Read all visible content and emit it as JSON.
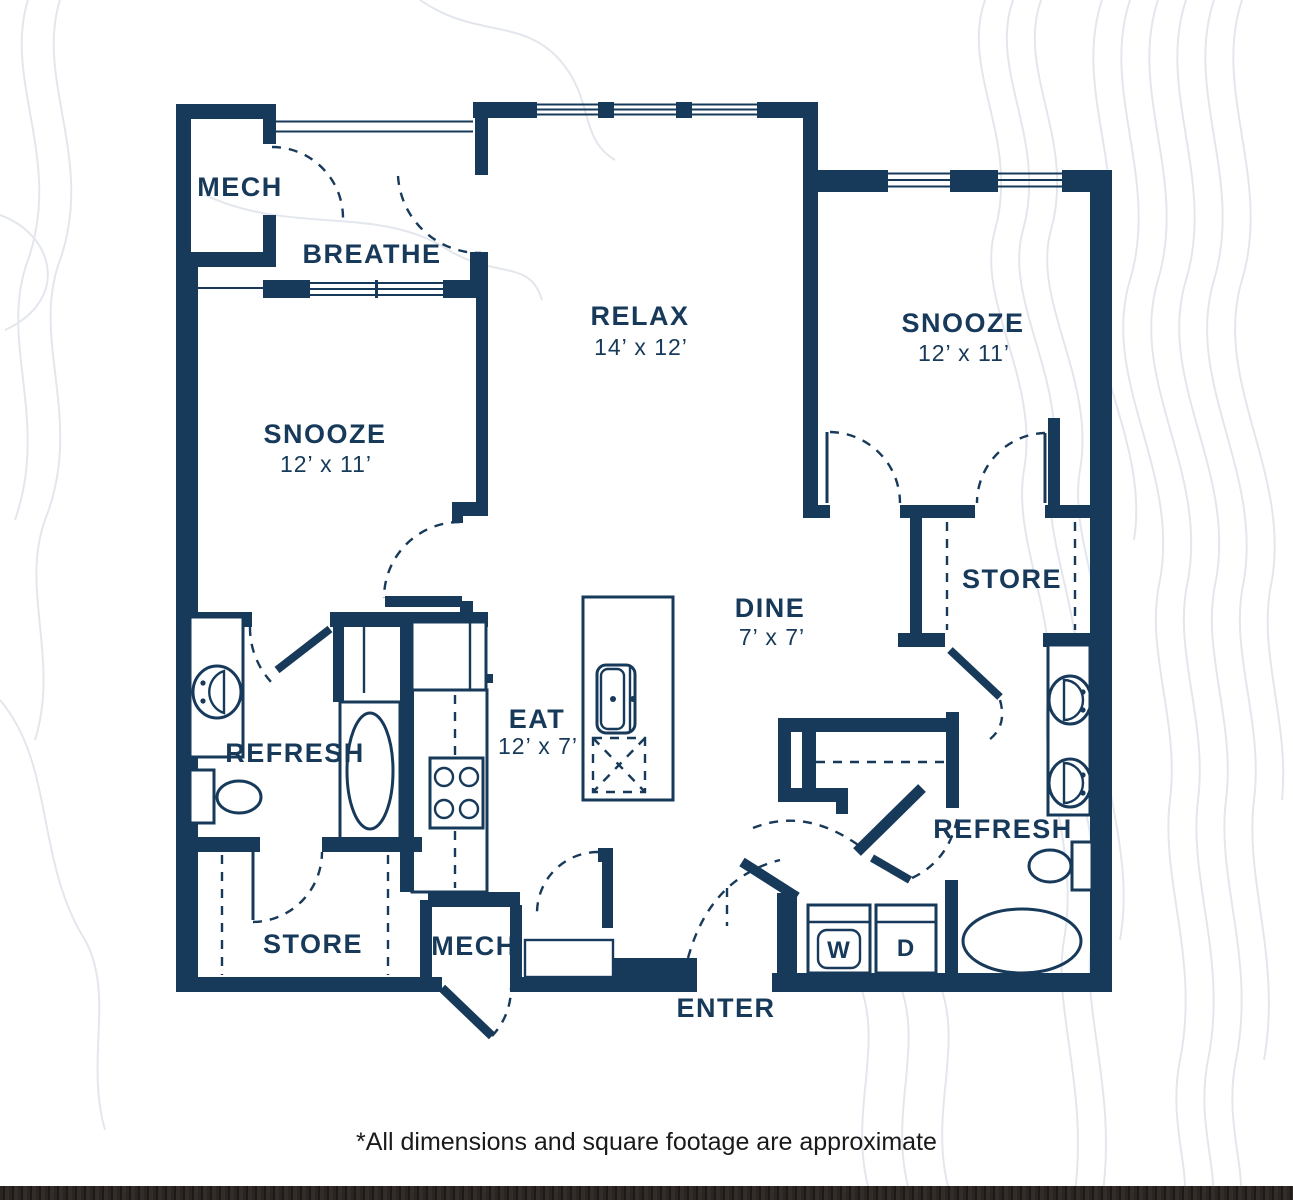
{
  "footnote": "*All dimensions and square footage are approximate",
  "colors": {
    "wall": "#17395A",
    "label_text": "#17395A",
    "contour_lines": "#E3E7ED",
    "footnote_text": "#1A1A1A",
    "footer_bar": "#272120",
    "background": "#FFFFFF"
  },
  "rooms": {
    "mech_top": {
      "label": "MECH"
    },
    "breathe": {
      "label": "BREATHE"
    },
    "relax": {
      "label": "RELAX",
      "dims": "14’ x 12’"
    },
    "snooze_right": {
      "label": "SNOOZE",
      "dims": "12’ x 11’"
    },
    "snooze_left": {
      "label": "SNOOZE",
      "dims": "12’ x 11’"
    },
    "store_right": {
      "label": "STORE"
    },
    "dine": {
      "label": "DINE",
      "dims": "7’ x 7’"
    },
    "eat": {
      "label": "EAT",
      "dims": "12’ x 7’"
    },
    "refresh_left": {
      "label": "REFRESH"
    },
    "refresh_right": {
      "label": "REFRESH"
    },
    "store_left": {
      "label": "STORE"
    },
    "mech_bottom": {
      "label": "MECH"
    },
    "enter": {
      "label": "ENTER"
    }
  },
  "appliances": {
    "washer": "W",
    "dryer": "D"
  }
}
